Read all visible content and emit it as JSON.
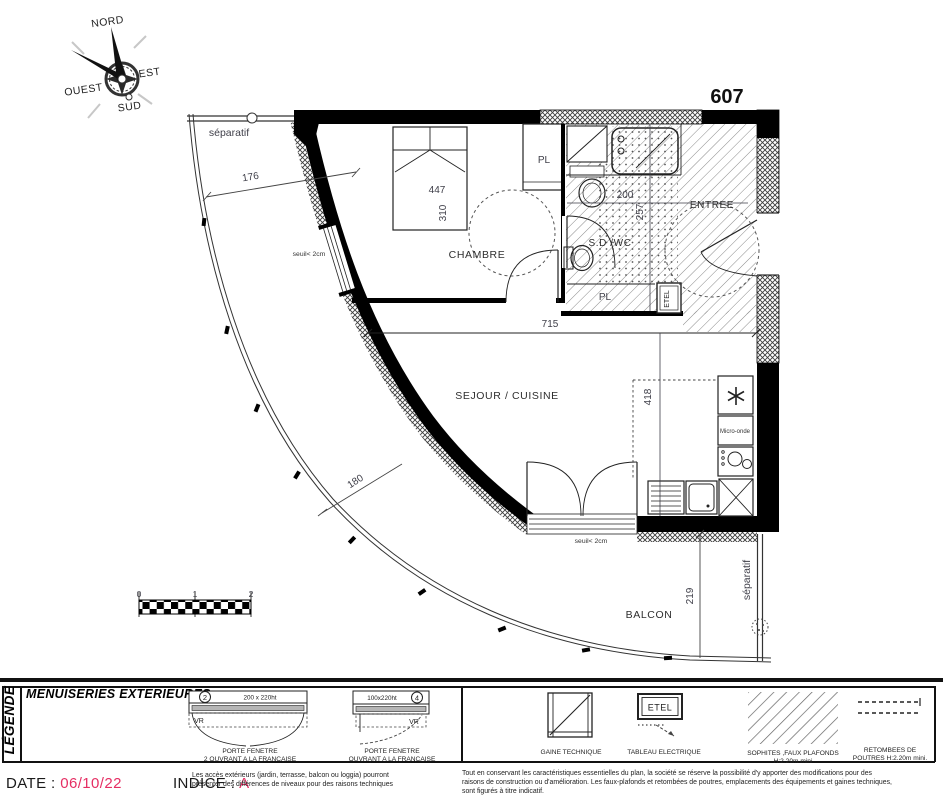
{
  "colors": {
    "accent_red": "#e52e63",
    "ink": "#000000",
    "hatch_gray": "#8a8a8a"
  },
  "compass": {
    "north": "NORD",
    "east": "EST",
    "south": "SUD",
    "west": "OUEST"
  },
  "plan": {
    "number": "607",
    "rooms": {
      "chambre": "CHAMBRE",
      "sdwc": "S.D /WC",
      "entree": "ENTREE",
      "sejour": "SEJOUR / CUISINE",
      "balcon": "BALCON",
      "pl_chambre": "PL",
      "pl_sdb": "PL",
      "etel": "ETEL",
      "micro": "Micro-onde"
    },
    "dims": {
      "d176": "176",
      "d447": "447",
      "d310": "310",
      "d200": "200",
      "d257": "257",
      "d715": "715",
      "d418": "418",
      "d180": "180",
      "d219": "219"
    },
    "notes": {
      "separatif_top": "séparatif",
      "separatif_right": "séparatif",
      "seuil_chambre": "seuil< 2cm",
      "seuil_sejour": "seuil< 2cm"
    },
    "scale": {
      "t0": "0",
      "t1": "1",
      "t2": "2"
    }
  },
  "legend": {
    "title": "LÉGENDE",
    "section": "MENUISERIES EXTERIEURES",
    "win2": {
      "num": "2",
      "size": "200 x 220ht",
      "vr": "VR",
      "l1": "PORTE FENETRE",
      "l2": "2 OUVRANT A LA FRANCAISE"
    },
    "win4": {
      "num": "4",
      "size": "100x220ht",
      "vr": "VR",
      "l1": "PORTE FENETRE",
      "l2": "OUVRANT A LA FRANCAISE"
    },
    "gaine": "GAINE TECHNIQUE",
    "tableau": {
      "tag": "ETEL",
      "label": "TABLEAU ELECTRIQUE"
    },
    "sophites": {
      "l1": "SOPHITES ,FAUX PLAFONDS",
      "l2": "H:2.20m mini"
    },
    "retombees": {
      "l1": "RETOMBEES DE",
      "l2": "POUTRES H:2.20m mini."
    }
  },
  "footer": {
    "date_label": "DATE :",
    "date_value": "06/10/22",
    "indice_label": "INDICE :",
    "indice_value": "A",
    "note_left_1": "Les accès extérieurs (jardin, terrasse, balcon ou loggia) pourront",
    "note_left_2": "présenter des différences de niveaux pour des raisons techniques",
    "note_right_1": "Tout en conservant les caractéristiques essentielles du plan, la société se réserve la possibilité d'y apporter des modifications pour des",
    "note_right_2": "raisons de construction ou d'amélioration. Les faux-plafonds et retombées de poutres, emplacements des équipements et gaines techniques,",
    "note_right_3": "sont figurés à titre indicatif."
  }
}
